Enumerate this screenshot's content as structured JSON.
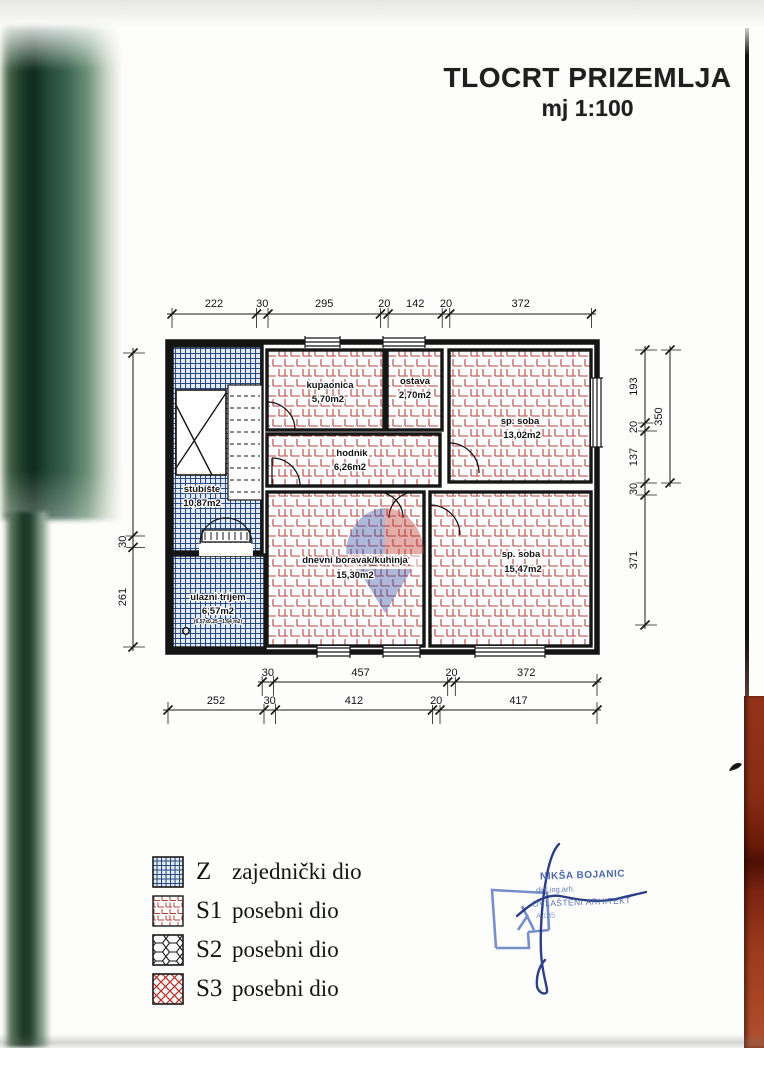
{
  "title": {
    "main": "TLOCRT PRIZEMLJA",
    "scale": "mj 1:100"
  },
  "plan": {
    "rooms": [
      {
        "name": "kupaonica",
        "area": "5,70m2"
      },
      {
        "name": "ostava",
        "area": "2,70m2"
      },
      {
        "name": "sp. soba",
        "area": "13,02m2"
      },
      {
        "name": "hodnik",
        "area": "6,26m2"
      },
      {
        "name": "stubište",
        "area": "10,87m2"
      },
      {
        "name": "ulazni trijem",
        "area": "6,57m2",
        "note": "(6,57x0,25 =1,64 m2)"
      },
      {
        "name": "dnevni boravak/kuhinja",
        "area": "15,30m2"
      },
      {
        "name": "sp. soba",
        "area": "15,47m2"
      }
    ],
    "dims": {
      "top": [
        "222",
        "30",
        "295",
        "20",
        "142",
        "20",
        "372"
      ],
      "bottom_upper": [
        "30",
        "457",
        "20",
        "372"
      ],
      "bottom_lower": [
        "252",
        "30",
        "412",
        "20",
        "417"
      ],
      "left": [
        "30",
        "261"
      ],
      "right": [
        "193",
        "20",
        "137",
        "30",
        "371"
      ],
      "right_outer": [
        "350"
      ]
    }
  },
  "legend": {
    "items": [
      {
        "code": "Z",
        "label": "zajednički dio"
      },
      {
        "code": "S1",
        "label": "posebni dio"
      },
      {
        "code": "S2",
        "label": "posebni dio"
      },
      {
        "code": "S3",
        "label": "posebni dio"
      }
    ]
  },
  "stamp": {
    "name": "NIKŠA BOJANIC",
    "title": "dipl.ing.arh.",
    "role": "OVLAŠTENI ARHITEKT",
    "number": "A 135"
  },
  "watermark": {
    "text": "REMAX"
  },
  "colors": {
    "hatch_blue": "#27497f",
    "hatch_red": "#b5413c",
    "stamp_blue": "#4a66ae",
    "wood": "#8a2c14"
  }
}
